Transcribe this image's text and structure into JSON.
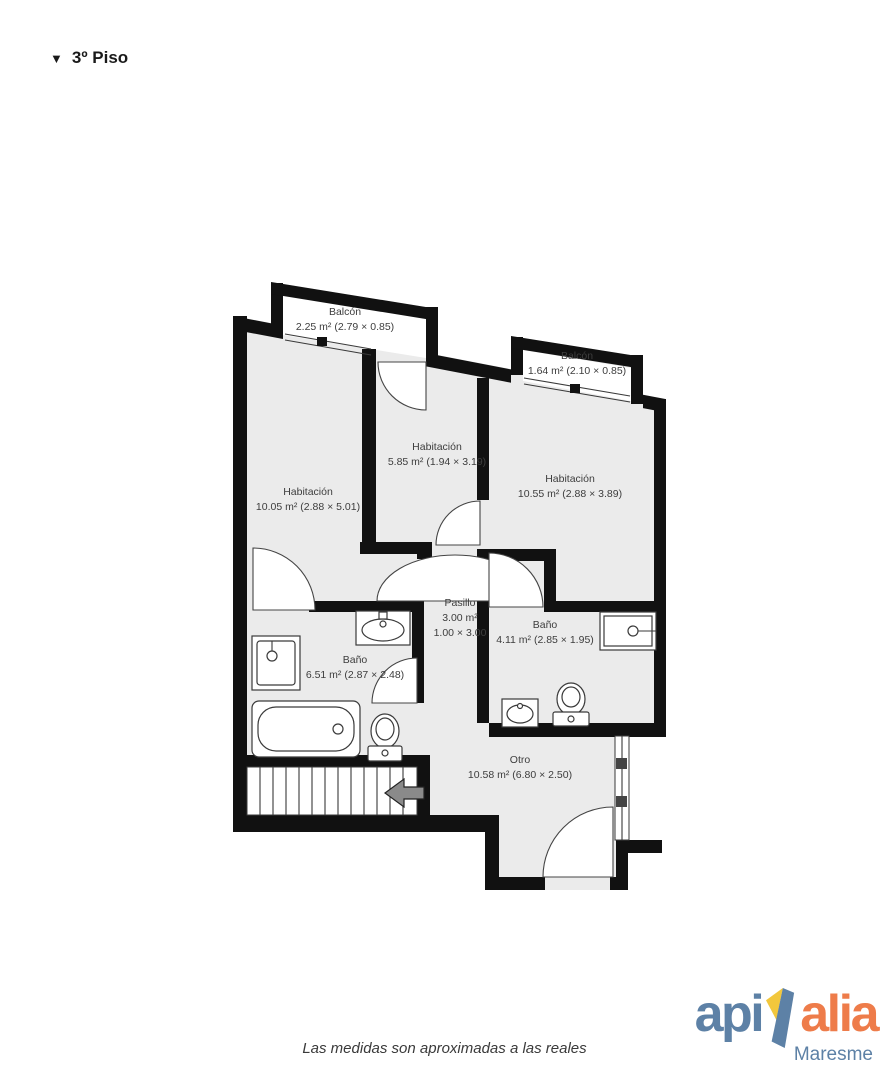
{
  "title": {
    "marker": "▼",
    "text": "3º Piso"
  },
  "floorplan": {
    "rooms": [
      {
        "id": "balcony-left",
        "name": "Balcón",
        "details": "2.25 m² (2.79 × 0.85)"
      },
      {
        "id": "balcony-right",
        "name": "Balcón",
        "details": "1.64 m² (2.10 × 0.85)"
      },
      {
        "id": "bedroom-middle",
        "name": "Habitación",
        "details": "5.85 m² (1.94 × 3.19)"
      },
      {
        "id": "bedroom-left",
        "name": "Habitación",
        "details": "10.05 m² (2.88 × 5.01)"
      },
      {
        "id": "bedroom-right",
        "name": "Habitación",
        "details": "10.55 m² (2.88 × 3.89)"
      },
      {
        "id": "hallway",
        "name": "Pasillo",
        "details": "3.00 m²",
        "details2": "1.00 × 3.00"
      },
      {
        "id": "bathroom-right",
        "name": "Baño",
        "details": "4.11 m² (2.85 × 1.95)"
      },
      {
        "id": "bathroom-left",
        "name": "Baño",
        "details": "6.51 m² (2.87 × 2.48)"
      },
      {
        "id": "other",
        "name": "Otro",
        "details": "10.58 m² (6.80 × 2.50)"
      }
    ],
    "colors": {
      "wall": "#111111",
      "room_fill": "#ebebeb",
      "outdoor_fill": "#ffffff"
    }
  },
  "footer": {
    "disclaimer": "Las medidas son aproximadas a las reales"
  },
  "logo": {
    "part1": "api",
    "part2": "alia",
    "region": "Maresme",
    "colors": {
      "blue": "#5d81a6",
      "orange": "#ee7c4a",
      "yellow": "#f2c73c"
    }
  }
}
